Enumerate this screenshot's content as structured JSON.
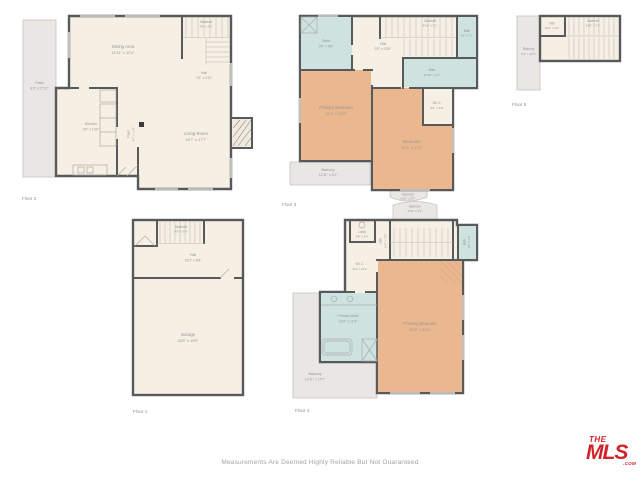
{
  "branding": {
    "disclaimer": "Measurements Are Deemed Highly Reliable But Not Guaranteed",
    "logo_the": "THE",
    "logo_mls": "MLS",
    "logo_com": ".COM"
  },
  "colors": {
    "wall": "#58595b",
    "floor_fill": "#f6efe4",
    "bedroom_fill": "#eab78f",
    "bath_fill": "#cee3e0",
    "outdoor_fill": "#e9e7e4",
    "label_text": "#949699",
    "logo_red": "#d2232a"
  },
  "floors": [
    {
      "label": "Floor 2",
      "rooms": [
        {
          "name": "Patio",
          "dims": "8'3\" x 27'11\""
        },
        {
          "name": "Dining Area",
          "dims": "19'11\" x 12'4\""
        },
        {
          "name": "Stairwell",
          "dims": "9'8\" x 3'4\""
        },
        {
          "name": "Hall",
          "dims": "7'6\" x 4'11\""
        },
        {
          "name": "Kitchen",
          "dims": "9'6\" x 13'0\""
        },
        {
          "name": "Foyer",
          "dims": "4'7\" x 13'4\""
        },
        {
          "name": "Living Room",
          "dims": "16'7\" x 17'7\""
        }
      ]
    },
    {
      "label": "Floor 3",
      "rooms": [
        {
          "name": "Bath",
          "dims": "9'9\" x 9'9\""
        },
        {
          "name": "Hall",
          "dims": "9'0\" x 12'6\""
        },
        {
          "name": "Stairwell",
          "dims": "8'10\" x 7'1\""
        },
        {
          "name": "Bath",
          "dims": "3'4\" x 7'1\""
        },
        {
          "name": "Bath",
          "dims": "10'10\" x 5'1\""
        },
        {
          "name": "Primary Bedroom",
          "dims": "12'1\" x 14'9\""
        },
        {
          "name": "Bedroom",
          "dims": "14'1\" x 17'1\""
        },
        {
          "name": "W.I.C.",
          "dims": "5'4\" x 5'8\""
        },
        {
          "name": "Balcony",
          "dims": "12'11\" x 3'2\""
        },
        {
          "name": "Balcony",
          "dims": "6'10\" x 3'2\""
        }
      ]
    },
    {
      "label": "Floor 5",
      "rooms": [
        {
          "name": "Hall",
          "dims": "2'11\" x 2'4\""
        },
        {
          "name": "Stairwell",
          "dims": "14'6\" x 7'1\""
        },
        {
          "name": "Balcony",
          "dims": "5'4\" x 12'4\""
        }
      ]
    },
    {
      "label": "Floor 1",
      "rooms": [
        {
          "name": "Stairwell",
          "dims": "9'8\" x 3'0\""
        },
        {
          "name": "Hall",
          "dims": "18'3\" x 9'8\""
        },
        {
          "name": "Garage",
          "dims": "18'3\" x 19'9\""
        }
      ]
    },
    {
      "label": "Floor 4",
      "rooms": [
        {
          "name": "Balcony",
          "dims": "6'10\" x 3'2\""
        },
        {
          "name": "Lndry",
          "dims": "3'8\" x 5'4\""
        },
        {
          "name": "Hall",
          "dims": "14'1\" x 7'5\""
        },
        {
          "name": "W.I.C.",
          "dims": "4'0\" x 12'4\""
        },
        {
          "name": "Bath",
          "dims": "3'8\" x 7'0\""
        },
        {
          "name": "Primary Bath",
          "dims": "10'4\" x 11'8\""
        },
        {
          "name": "Primary Bedroom",
          "dims": "14'2\" x 22'0\""
        },
        {
          "name": "Balcony",
          "dims": "14'11\" x 17'7\""
        }
      ]
    }
  ]
}
